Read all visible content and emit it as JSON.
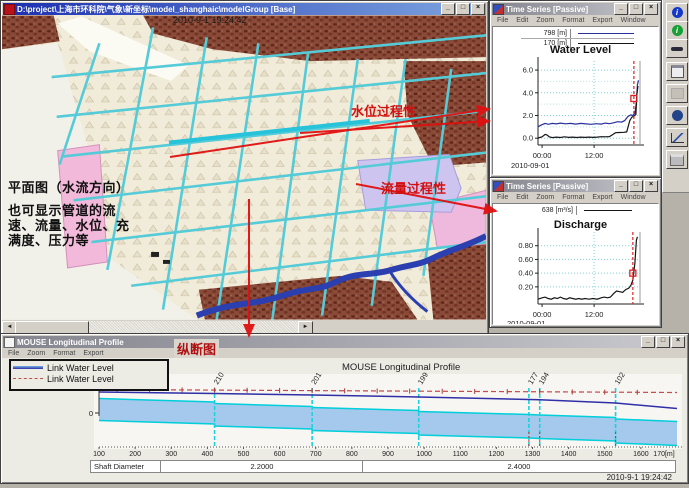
{
  "icons": {
    "minimize": "_",
    "maximize": "□",
    "close": "×",
    "scroll_left": "◄",
    "scroll_right": "►",
    "info": "i"
  },
  "colors": {
    "annotation_red": "#d40f0f",
    "grid_cyan": "#7fd4d4",
    "series_blue": "#28309a",
    "series_black": "#151515",
    "band_fill": "#a5c9ec",
    "band_edge": "#00cfdb",
    "water_blue": "#2f2fa8",
    "max_red": "#c24b4b",
    "cursor_red": "#dd2222"
  },
  "map_window": {
    "title": "D:\\project\\上海市环科院\\气象\\新坐标\\model_shanghaic\\modelGroup [Base]",
    "datetime_overlay": "2010-9-1 19:24:42",
    "annotations": {
      "plan_view": "平面图（水流方向）",
      "note_line1": "也可显示管道的流",
      "note_line2": "速、流量、水位、充",
      "note_line3": "满度、压力等",
      "water_level_label": "水位过程性",
      "discharge_label": "流量过程性",
      "profile_label": "纵断图"
    }
  },
  "ts_water": {
    "title": "Time Series [Passive]",
    "menu": [
      "File",
      "Edit",
      "Zoom",
      "Format",
      "Export",
      "Window"
    ],
    "legend": [
      {
        "label": "798 [m]"
      },
      {
        "label": "170 [m]"
      }
    ],
    "chart": {
      "type": "line",
      "title": "Water Level",
      "y_range": [
        -0.6,
        6.8
      ],
      "y_ticks": [
        {
          "v": 0,
          "label": "0.0"
        },
        {
          "v": 2,
          "label": "2.0"
        },
        {
          "v": 4,
          "label": "4.0"
        },
        {
          "v": 6,
          "label": "6.0"
        }
      ],
      "y_minor": [
        1,
        3,
        5
      ],
      "x_ticks": [
        {
          "v": 0.04,
          "label": "00:00"
        },
        {
          "v": 0.55,
          "label": "12:00"
        }
      ],
      "date_label": "2010-09-01",
      "cursor_x": 0.94,
      "marker": {
        "x": 0.94,
        "y": 3.5
      },
      "series": [
        {
          "name": "798 [m]",
          "color": "#28309a",
          "points": [
            [
              0,
              1.0
            ],
            [
              0.03,
              1.15
            ],
            [
              0.07,
              1.3
            ],
            [
              0.1,
              1.22
            ],
            [
              0.14,
              1.3
            ],
            [
              0.18,
              1.26
            ],
            [
              0.22,
              1.33
            ],
            [
              0.27,
              1.27
            ],
            [
              0.32,
              1.3
            ],
            [
              0.37,
              1.24
            ],
            [
              0.42,
              1.3
            ],
            [
              0.47,
              1.26
            ],
            [
              0.52,
              1.22
            ],
            [
              0.57,
              1.28
            ],
            [
              0.62,
              1.24
            ],
            [
              0.66,
              1.33
            ],
            [
              0.7,
              1.28
            ],
            [
              0.74,
              1.36
            ],
            [
              0.78,
              1.45
            ],
            [
              0.82,
              1.42
            ],
            [
              0.85,
              1.55
            ],
            [
              0.88,
              1.9
            ],
            [
              0.91,
              2.05
            ],
            [
              0.93,
              2.0
            ],
            [
              0.95,
              2.2
            ],
            [
              0.965,
              3.2
            ],
            [
              0.975,
              4.7
            ],
            [
              0.985,
              5.1
            ]
          ]
        },
        {
          "name": "170 [m]",
          "color": "#151515",
          "points": [
            [
              0,
              0.02
            ],
            [
              0.04,
              0.12
            ],
            [
              0.07,
              0.33
            ],
            [
              0.09,
              0.28
            ],
            [
              0.11,
              0.12
            ],
            [
              0.14,
              0.05
            ],
            [
              0.18,
              0.1
            ],
            [
              0.22,
              0.06
            ],
            [
              0.26,
              0.12
            ],
            [
              0.3,
              0.07
            ],
            [
              0.34,
              0.1
            ],
            [
              0.38,
              0.06
            ],
            [
              0.42,
              0.1
            ],
            [
              0.46,
              0.07
            ],
            [
              0.5,
              0.1
            ],
            [
              0.54,
              0.07
            ],
            [
              0.58,
              0.1
            ],
            [
              0.62,
              0.13
            ],
            [
              0.66,
              0.12
            ],
            [
              0.7,
              0.14
            ],
            [
              0.73,
              0.3
            ],
            [
              0.76,
              0.48
            ],
            [
              0.8,
              0.5
            ],
            [
              0.84,
              0.52
            ],
            [
              0.87,
              0.55
            ],
            [
              0.9,
              1.55
            ],
            [
              0.92,
              1.85
            ],
            [
              0.94,
              1.95
            ],
            [
              0.96,
              2.1
            ],
            [
              0.97,
              3.9
            ],
            [
              0.98,
              4.6
            ]
          ]
        }
      ]
    }
  },
  "ts_discharge": {
    "title": "Time Series [Passive]",
    "menu": [
      "File",
      "Edit",
      "Zoom",
      "Format",
      "Export",
      "Window"
    ],
    "legend": [
      {
        "label": "638 [m³/s]"
      }
    ],
    "chart": {
      "type": "line",
      "title": "Discharge",
      "y_range": [
        -0.05,
        1.0
      ],
      "y_ticks": [
        {
          "v": 0.2,
          "label": "0.20"
        },
        {
          "v": 0.4,
          "label": "0.40"
        },
        {
          "v": 0.6,
          "label": "0.60"
        },
        {
          "v": 0.8,
          "label": "0.80"
        }
      ],
      "y_minor": [],
      "x_ticks": [
        {
          "v": 0.04,
          "label": "00:00"
        },
        {
          "v": 0.55,
          "label": "12:00"
        }
      ],
      "date_label": "2010-09-01",
      "cursor_x": 0.93,
      "marker": {
        "x": 0.93,
        "y": 0.4
      },
      "series": [
        {
          "name": "638 [m³/s]",
          "color": "#151515",
          "points": [
            [
              0,
              0.02
            ],
            [
              0.04,
              0.04
            ],
            [
              0.07,
              0.05
            ],
            [
              0.1,
              0.03
            ],
            [
              0.13,
              0.02
            ],
            [
              0.16,
              0.04
            ],
            [
              0.19,
              0.03
            ],
            [
              0.22,
              0.05
            ],
            [
              0.25,
              0.03
            ],
            [
              0.28,
              0.02
            ],
            [
              0.31,
              0.04
            ],
            [
              0.34,
              0.03
            ],
            [
              0.37,
              0.02
            ],
            [
              0.4,
              0.03
            ],
            [
              0.43,
              0.02
            ],
            [
              0.46,
              0.03
            ],
            [
              0.5,
              0.02
            ],
            [
              0.54,
              0.03
            ],
            [
              0.58,
              0.02
            ],
            [
              0.62,
              0.04
            ],
            [
              0.65,
              0.05
            ],
            [
              0.68,
              0.04
            ],
            [
              0.71,
              0.05
            ],
            [
              0.74,
              0.1
            ],
            [
              0.77,
              0.14
            ],
            [
              0.8,
              0.13
            ],
            [
              0.83,
              0.12
            ],
            [
              0.86,
              0.16
            ],
            [
              0.89,
              0.18
            ],
            [
              0.91,
              0.22
            ],
            [
              0.93,
              0.3
            ],
            [
              0.95,
              0.55
            ],
            [
              0.965,
              0.88
            ],
            [
              0.975,
              0.93
            ]
          ]
        }
      ]
    }
  },
  "profile_window": {
    "title": "MOUSE Longitudinal Profile",
    "menu": [
      "File",
      "Zoom",
      "Format",
      "Export"
    ],
    "legend": [
      {
        "label": "Link Water Level"
      },
      {
        "label": "Link Water Level"
      }
    ],
    "status_datetime": "2010-9-1 19:24:42",
    "shaft": {
      "label": "Shaft Diameter",
      "values": [
        "2.2000",
        "2.4000"
      ]
    },
    "chart": {
      "type": "profile",
      "title": "MOUSE Longitudinal Profile",
      "unit_label": "[m]",
      "zero_label": "0",
      "x_end_label": "170[m]",
      "x_ticks": [
        100,
        200,
        300,
        400,
        500,
        600,
        700,
        800,
        900,
        1000,
        1100,
        1200,
        1300,
        1400,
        1500,
        1600
      ],
      "nodes": [
        {
          "label": "210",
          "m": 420
        },
        {
          "label": "201",
          "m": 690
        },
        {
          "label": "199",
          "m": 985
        },
        {
          "label": "177",
          "m": 1290
        },
        {
          "label": "194",
          "m": 1320
        },
        {
          "label": "102",
          "m": 1530
        }
      ],
      "max_line": [
        [
          100,
          2.35
        ],
        [
          1700,
          2.05
        ]
      ],
      "water_line": [
        [
          100,
          2.1
        ],
        [
          420,
          1.95
        ],
        [
          690,
          1.8
        ],
        [
          985,
          1.6
        ],
        [
          1290,
          1.35
        ],
        [
          1320,
          1.33
        ],
        [
          1530,
          1.0
        ],
        [
          1700,
          0.45
        ]
      ],
      "band_top": [
        [
          100,
          1.45
        ],
        [
          420,
          1.1
        ],
        [
          420,
          0.95
        ],
        [
          690,
          0.65
        ],
        [
          690,
          0.55
        ],
        [
          985,
          0.25
        ],
        [
          985,
          0.15
        ],
        [
          1290,
          -0.15
        ],
        [
          1320,
          -0.2
        ],
        [
          1530,
          -0.45
        ],
        [
          1530,
          -0.6
        ],
        [
          1700,
          -0.85
        ]
      ],
      "band_bottom": [
        [
          100,
          -0.75
        ],
        [
          420,
          -1.1
        ],
        [
          420,
          -1.3
        ],
        [
          690,
          -1.6
        ],
        [
          690,
          -1.75
        ],
        [
          985,
          -2.05
        ],
        [
          985,
          -2.2
        ],
        [
          1290,
          -2.5
        ],
        [
          1320,
          -2.55
        ],
        [
          1530,
          -2.8
        ],
        [
          1530,
          -3.0
        ],
        [
          1700,
          -3.25
        ]
      ],
      "red_marks": [
        1290,
        1320,
        1530
      ]
    }
  }
}
